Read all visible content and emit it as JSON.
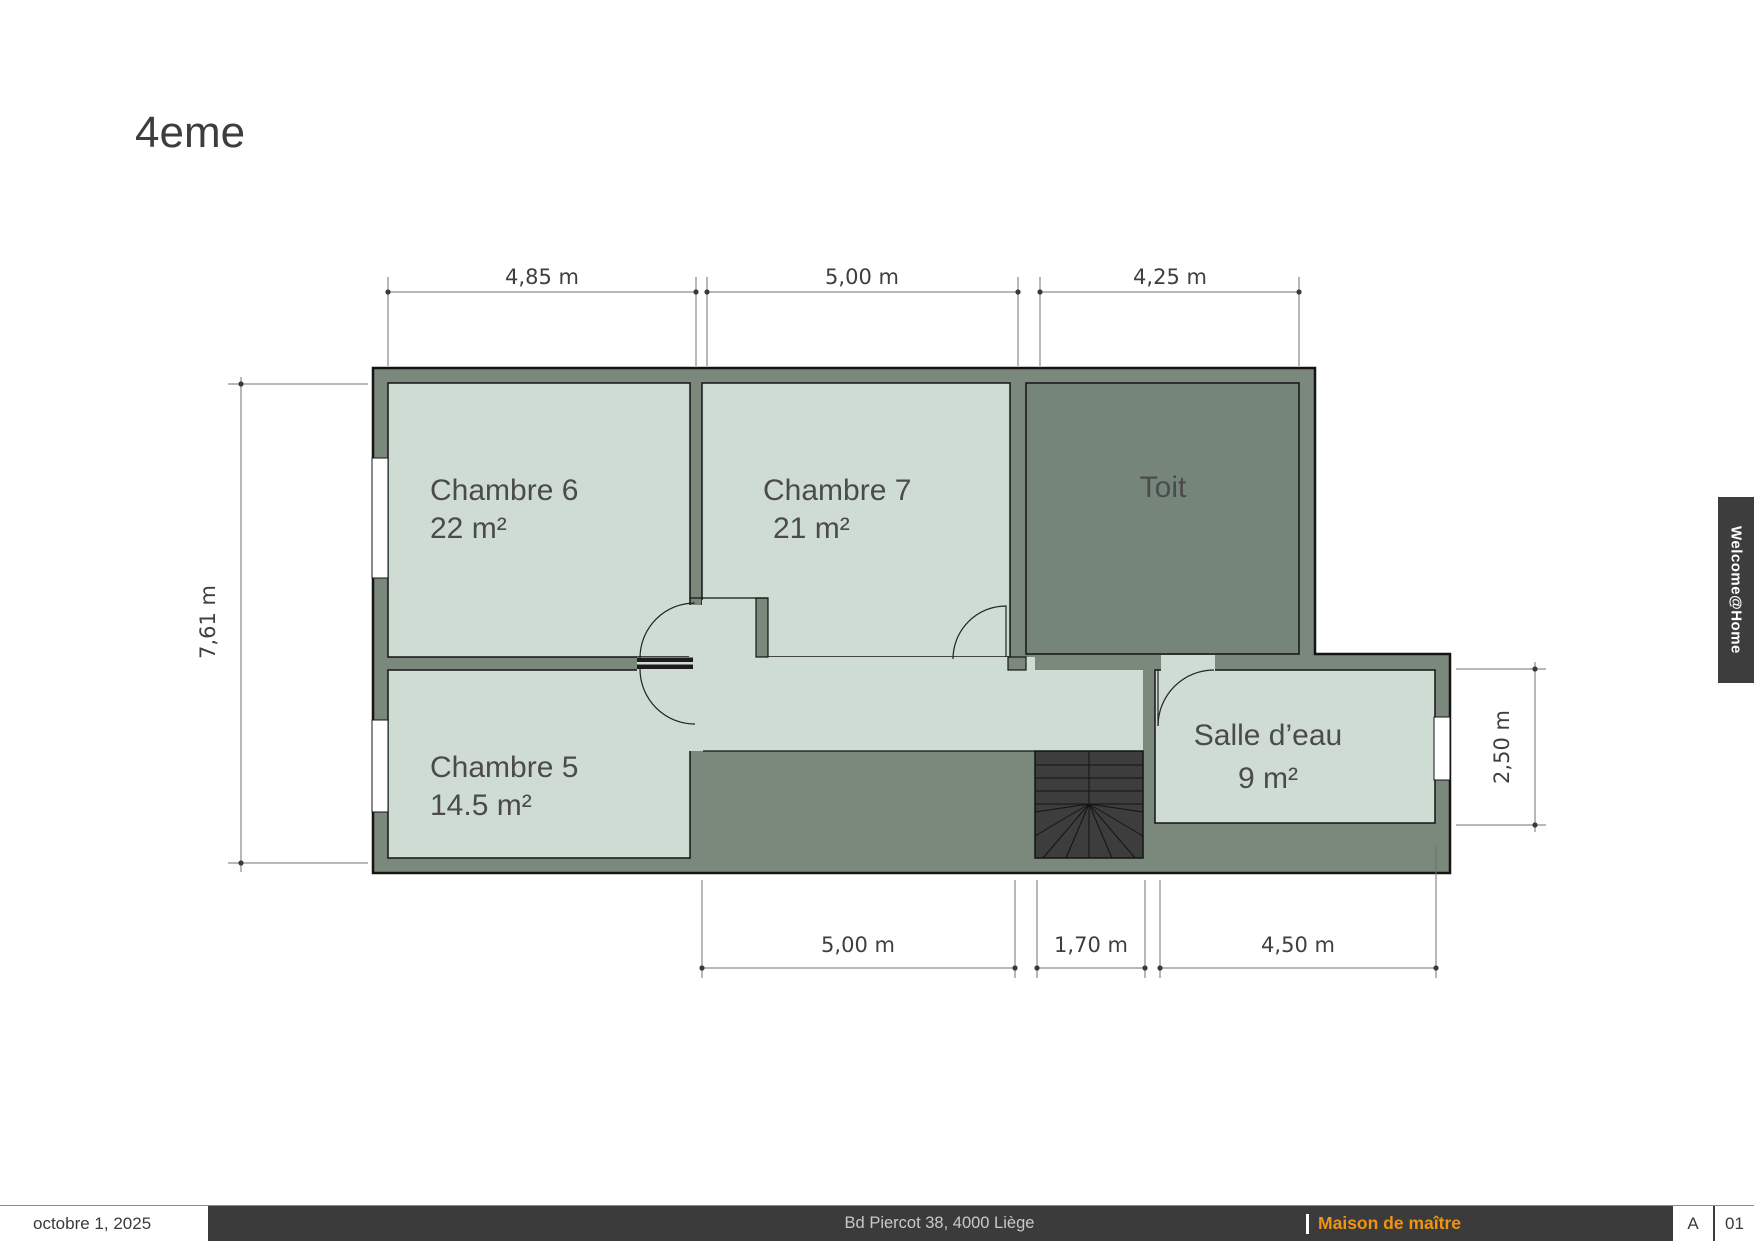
{
  "title": "4eme",
  "plan": {
    "rooms": [
      {
        "label": "Chambre 6",
        "area": "22 m²"
      },
      {
        "label": "Chambre 7",
        "area": "21 m²"
      },
      {
        "label": "Toit"
      },
      {
        "label": "Chambre 5",
        "area": "14.5 m²"
      },
      {
        "label": "Salle d’eau",
        "area": "9 m²"
      }
    ],
    "dimensions": {
      "top": [
        "4,85 m",
        "5,00 m",
        "4,25 m"
      ],
      "left": "7,61 m",
      "right": "2,50 m",
      "bottom": [
        "5,00 m",
        "1,70 m",
        "4,50 m"
      ]
    },
    "colors": {
      "wall": "#7a897b",
      "room_fill": "#cfdcd3",
      "toit_fill": "#75857a",
      "stairs_fill": "#3d3d3d",
      "outline": "#141414",
      "dimension": "#707070"
    }
  },
  "side_tab": {
    "label": "Welcome@Home"
  },
  "footer": {
    "date": "octobre 1, 2025",
    "address": "Bd Piercot 38, 4000 Liège",
    "project": "Maison de maître",
    "revision": "A",
    "sheet": "01",
    "accent": "#ef9412",
    "bar_color": "#3b3b3b"
  }
}
